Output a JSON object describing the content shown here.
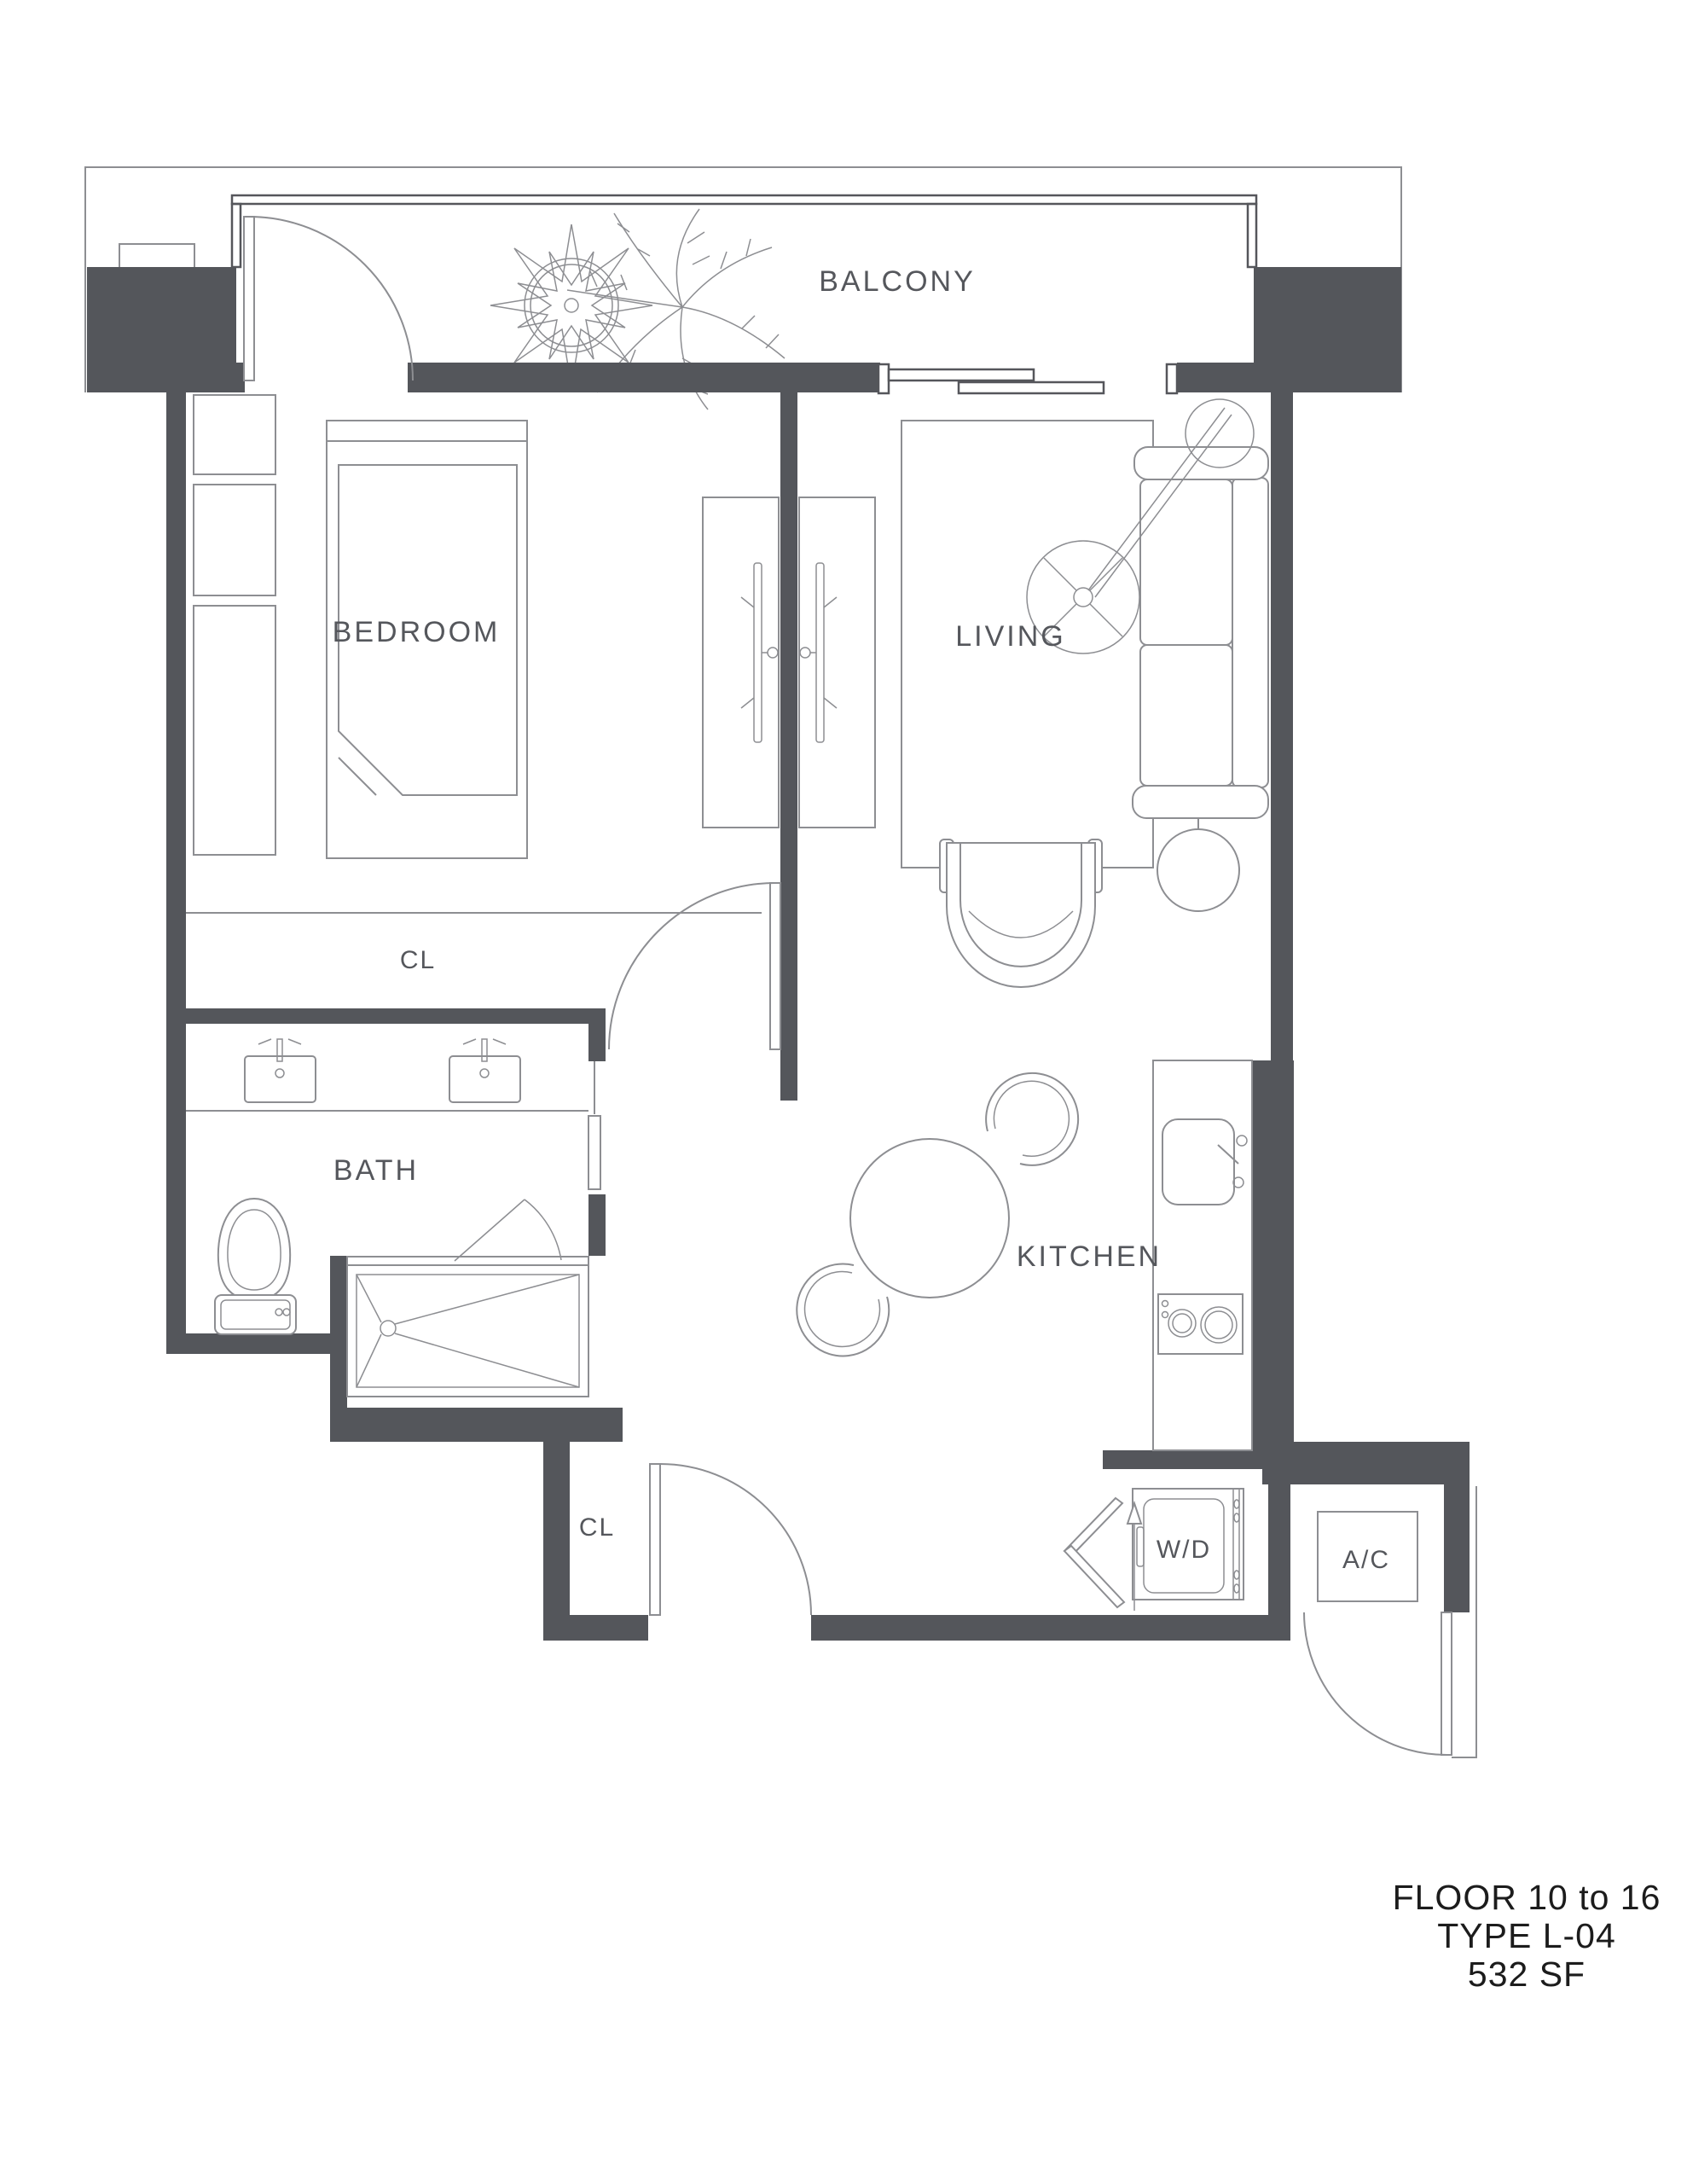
{
  "colors": {
    "wall": "#54565b",
    "line": "#8d8e92",
    "label": "#55575c",
    "title": "#1c1c1c"
  },
  "labels": {
    "balcony": "BALCONY",
    "bedroom": "BEDROOM",
    "living": "LIVING",
    "bedroom_closet": "CL",
    "bath": "BATH",
    "kitchen": "KITCHEN",
    "entry_closet": "CL",
    "washer_dryer": "W/D",
    "air_conditioner": "A/C"
  },
  "title_block": {
    "floor": "FLOOR 10 to 16",
    "type": "TYPE L-04",
    "area": "532 SF"
  }
}
